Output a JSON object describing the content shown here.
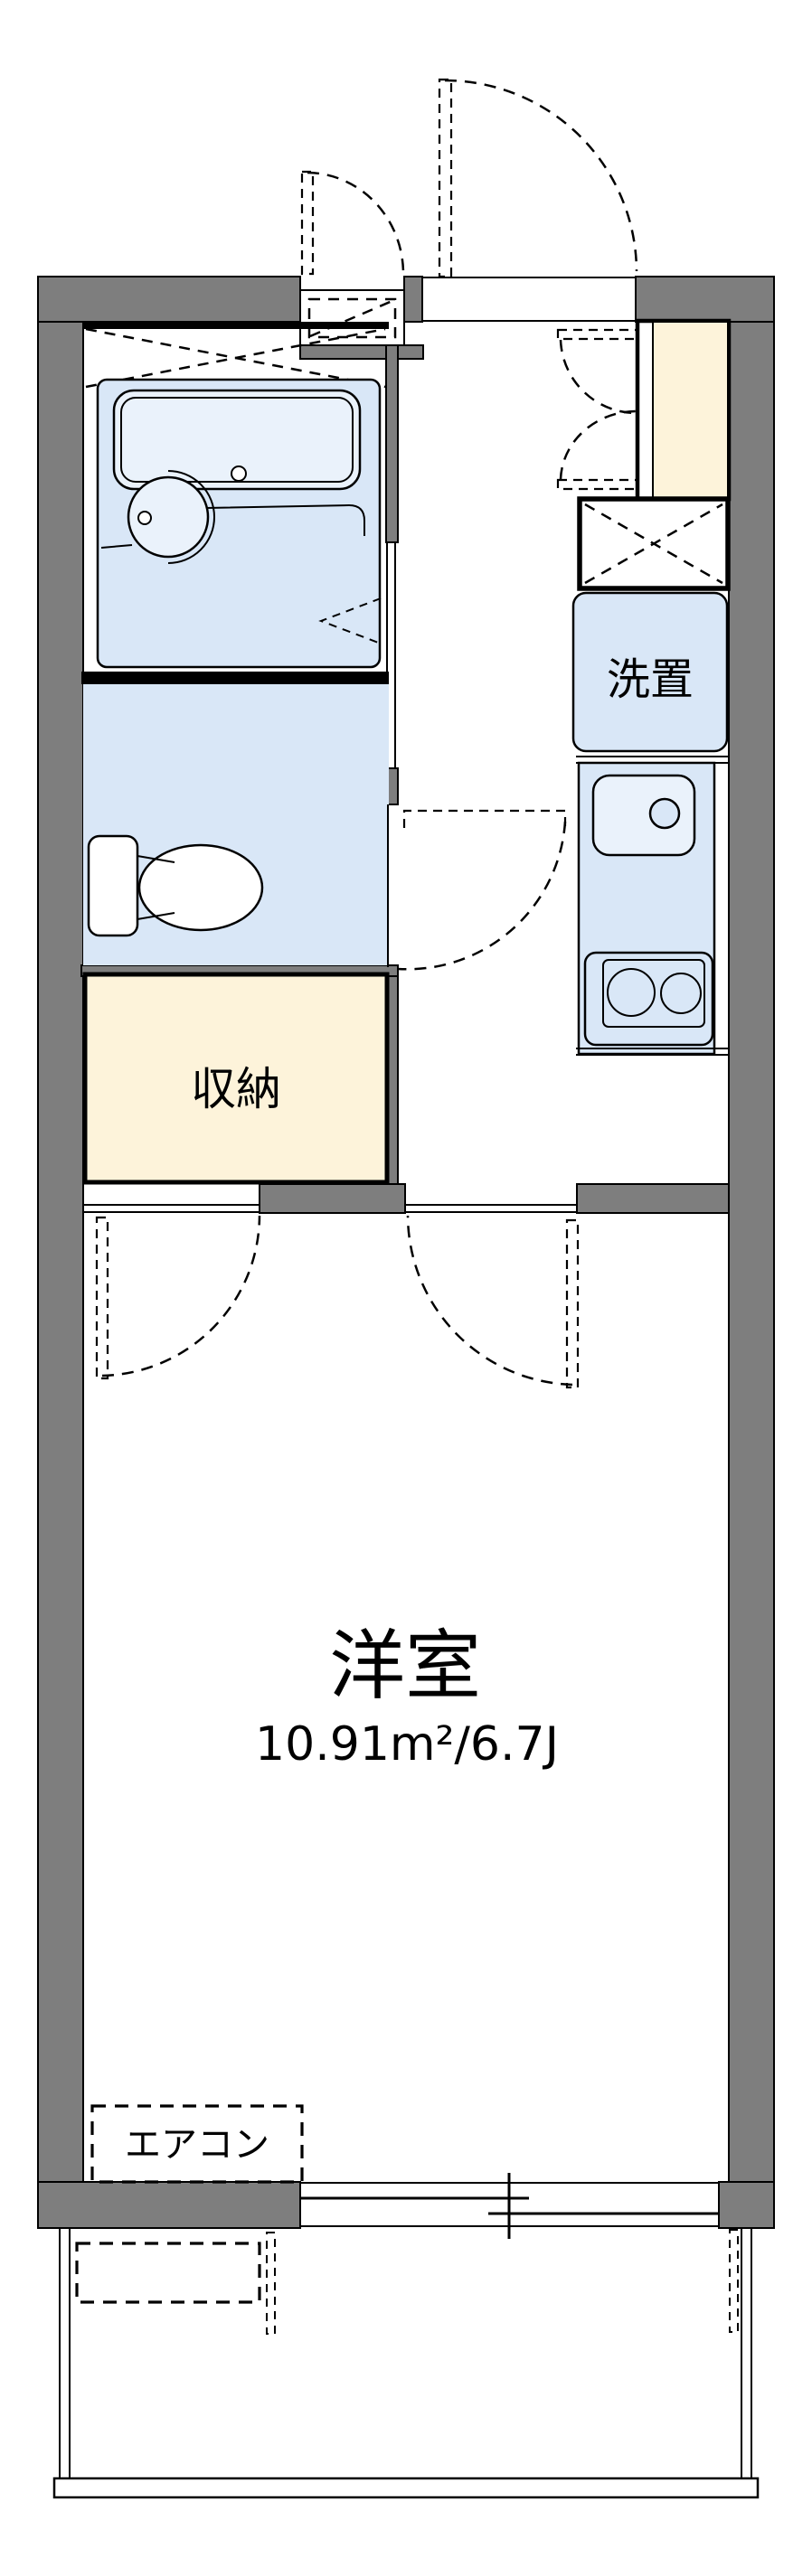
{
  "rooms": {
    "western": {
      "label": "洋室",
      "area": "10.91m²/6.7J"
    },
    "storage": {
      "label": "収納"
    },
    "washer": {
      "label": "洗置"
    },
    "aircon": {
      "label": "エアコン"
    }
  },
  "colors": {
    "wall": "#7e7e7e",
    "water": "#d9e7f7",
    "waterlt": "#eaf2fb",
    "cream": "#fdf3da",
    "line": "#000000",
    "bg": "#ffffff"
  }
}
